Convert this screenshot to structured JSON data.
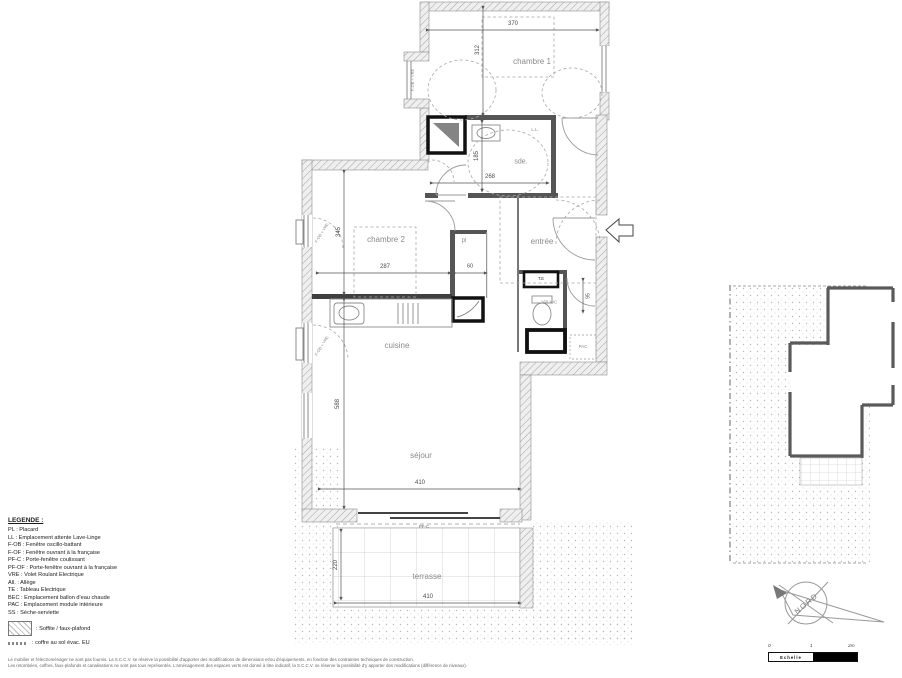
{
  "plan": {
    "rooms": {
      "chambre1": "chambre 1",
      "chambre2": "chambre 2",
      "sde": "sde.",
      "entree": "entrée",
      "cuisine": "cuisine",
      "sejour": "séjour",
      "terrasse": "terrasse",
      "pl": "pl",
      "wc": "160 WC",
      "pac": "PAC",
      "te": "T.E",
      "ll": "L.L."
    },
    "dims": {
      "d370": "370",
      "d312": "312",
      "d268": "268",
      "d185": "185",
      "d345": "345",
      "d287": "287",
      "d60": "60",
      "d95": "95",
      "d410_sejour": "410",
      "d588": "588",
      "d410_terrasse": "410",
      "d220": "220"
    },
    "annotations": {
      "pfc": "PF-C",
      "window_label": "F-OB + VRE"
    }
  },
  "legend": {
    "title": "LEGENDE :",
    "items": [
      "PL : Placard",
      "LL : Emplacement attente Lave-Linge",
      "F-OB : Fenêtre oscillo-battant",
      "F-OF : Fenêtre ouvrant à la française",
      "PF-C : Porte-fenêtre coulissant",
      "PF-OF : Porte-fenêtre ouvrant à la française",
      "VRE : Volet Roulant Electrique",
      "All. : Allège",
      "TE : Tableau Electrique",
      "BEC : Emplacement ballon d'eau chaude",
      "PAC : Emplacement module intérieure",
      "SS : Sèche-serviette"
    ],
    "soffite": ": Soffite / faux-plafond",
    "coffre": ": coffre au sol évac. EU"
  },
  "disclaimer": {
    "line1": "Le mobilier et l'électroménager ne sont pas fournis. La S.C.C.V. se réserve la possibilité d'apporter des modifications de dimensions et/ou d'équipements, en fonction des contraintes techniques de construction.",
    "line2": "Les retombées, coffres, faux-plafonds et canalisations ne sont pas tous représentés. L'aménagement des espaces verts est donné à titre indicatif, la S.C.C.V. se réserve la possibilité d'y apporter des modifications (différence de niveaux)."
  },
  "compass": {
    "north_label": "NORD"
  },
  "scalebar": {
    "tick0": "0",
    "tick1": "1",
    "tick2": "2m",
    "label": "Echelle"
  }
}
